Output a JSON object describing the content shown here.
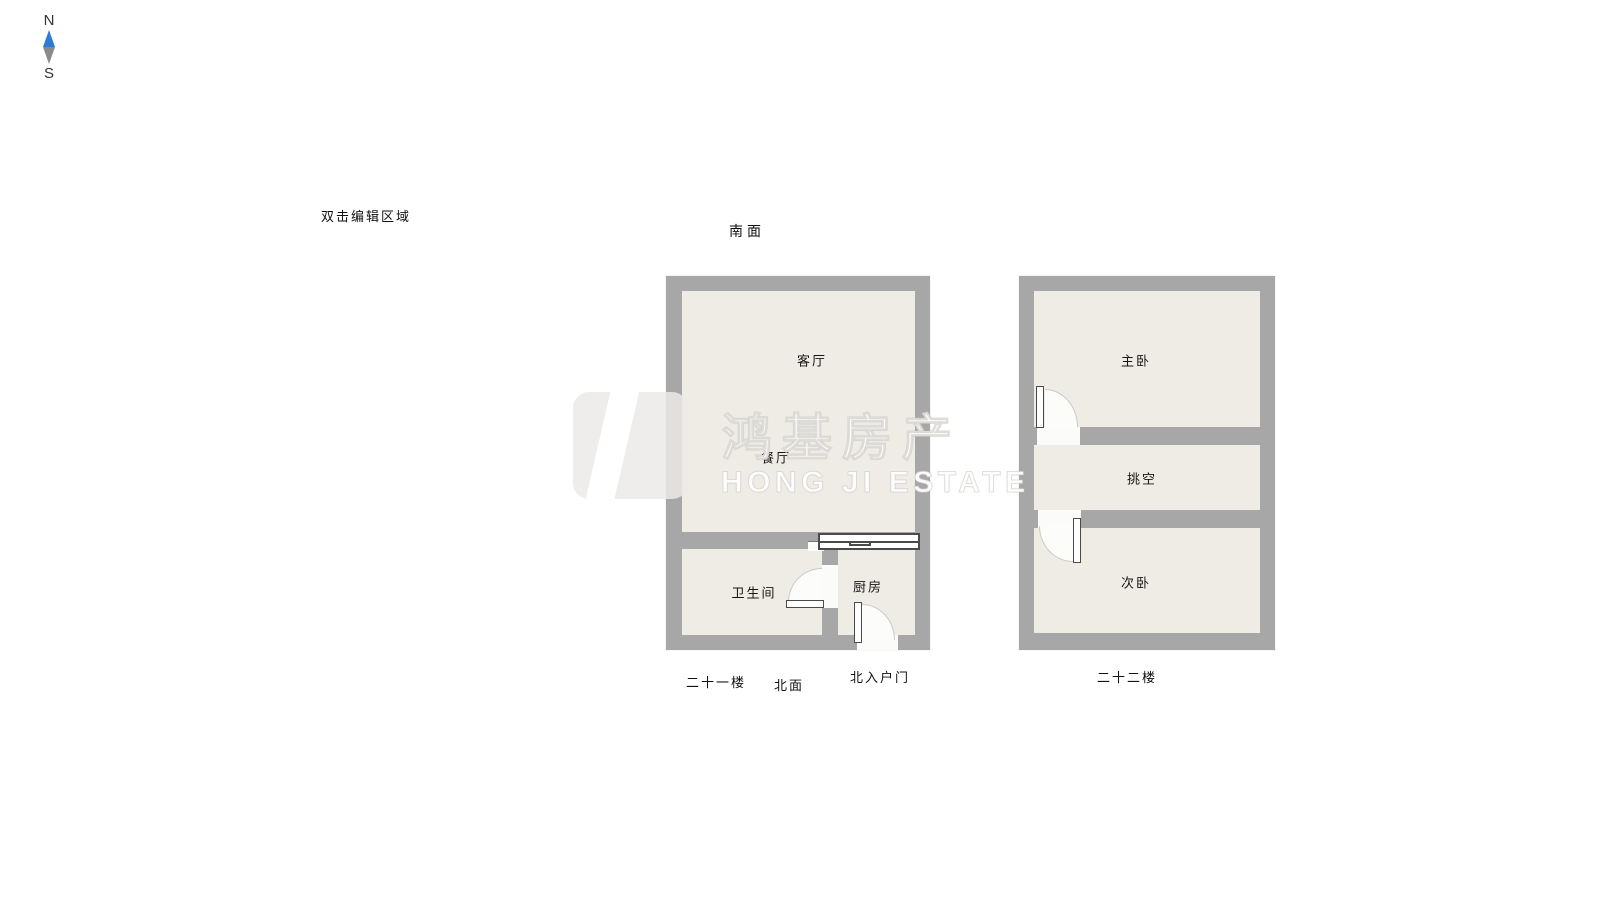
{
  "compass": {
    "north": "N",
    "south": "S"
  },
  "hint": "双击编辑区域",
  "south_side_label": "南面",
  "watermark": {
    "cn": "鸿基房产",
    "en": "HONG JI ESTATE"
  },
  "floor21": {
    "title": "二十一楼",
    "north_side_label": "北面",
    "entry_label": "北入户门",
    "rooms": {
      "living": "客厅",
      "dining": "餐厅",
      "bathroom": "卫生间",
      "kitchen": "厨房"
    }
  },
  "floor22": {
    "title": "二十二楼",
    "rooms": {
      "master": "主卧",
      "void": "挑空",
      "secondary": "次卧"
    }
  },
  "colors": {
    "wall": "#a7a7a7",
    "room_fill": "#efece6",
    "door_line": "#4a4a4a",
    "window_line": "#4a4a4a",
    "compass_north": "#2e7bd6",
    "compass_south": "#8a8a8a"
  }
}
